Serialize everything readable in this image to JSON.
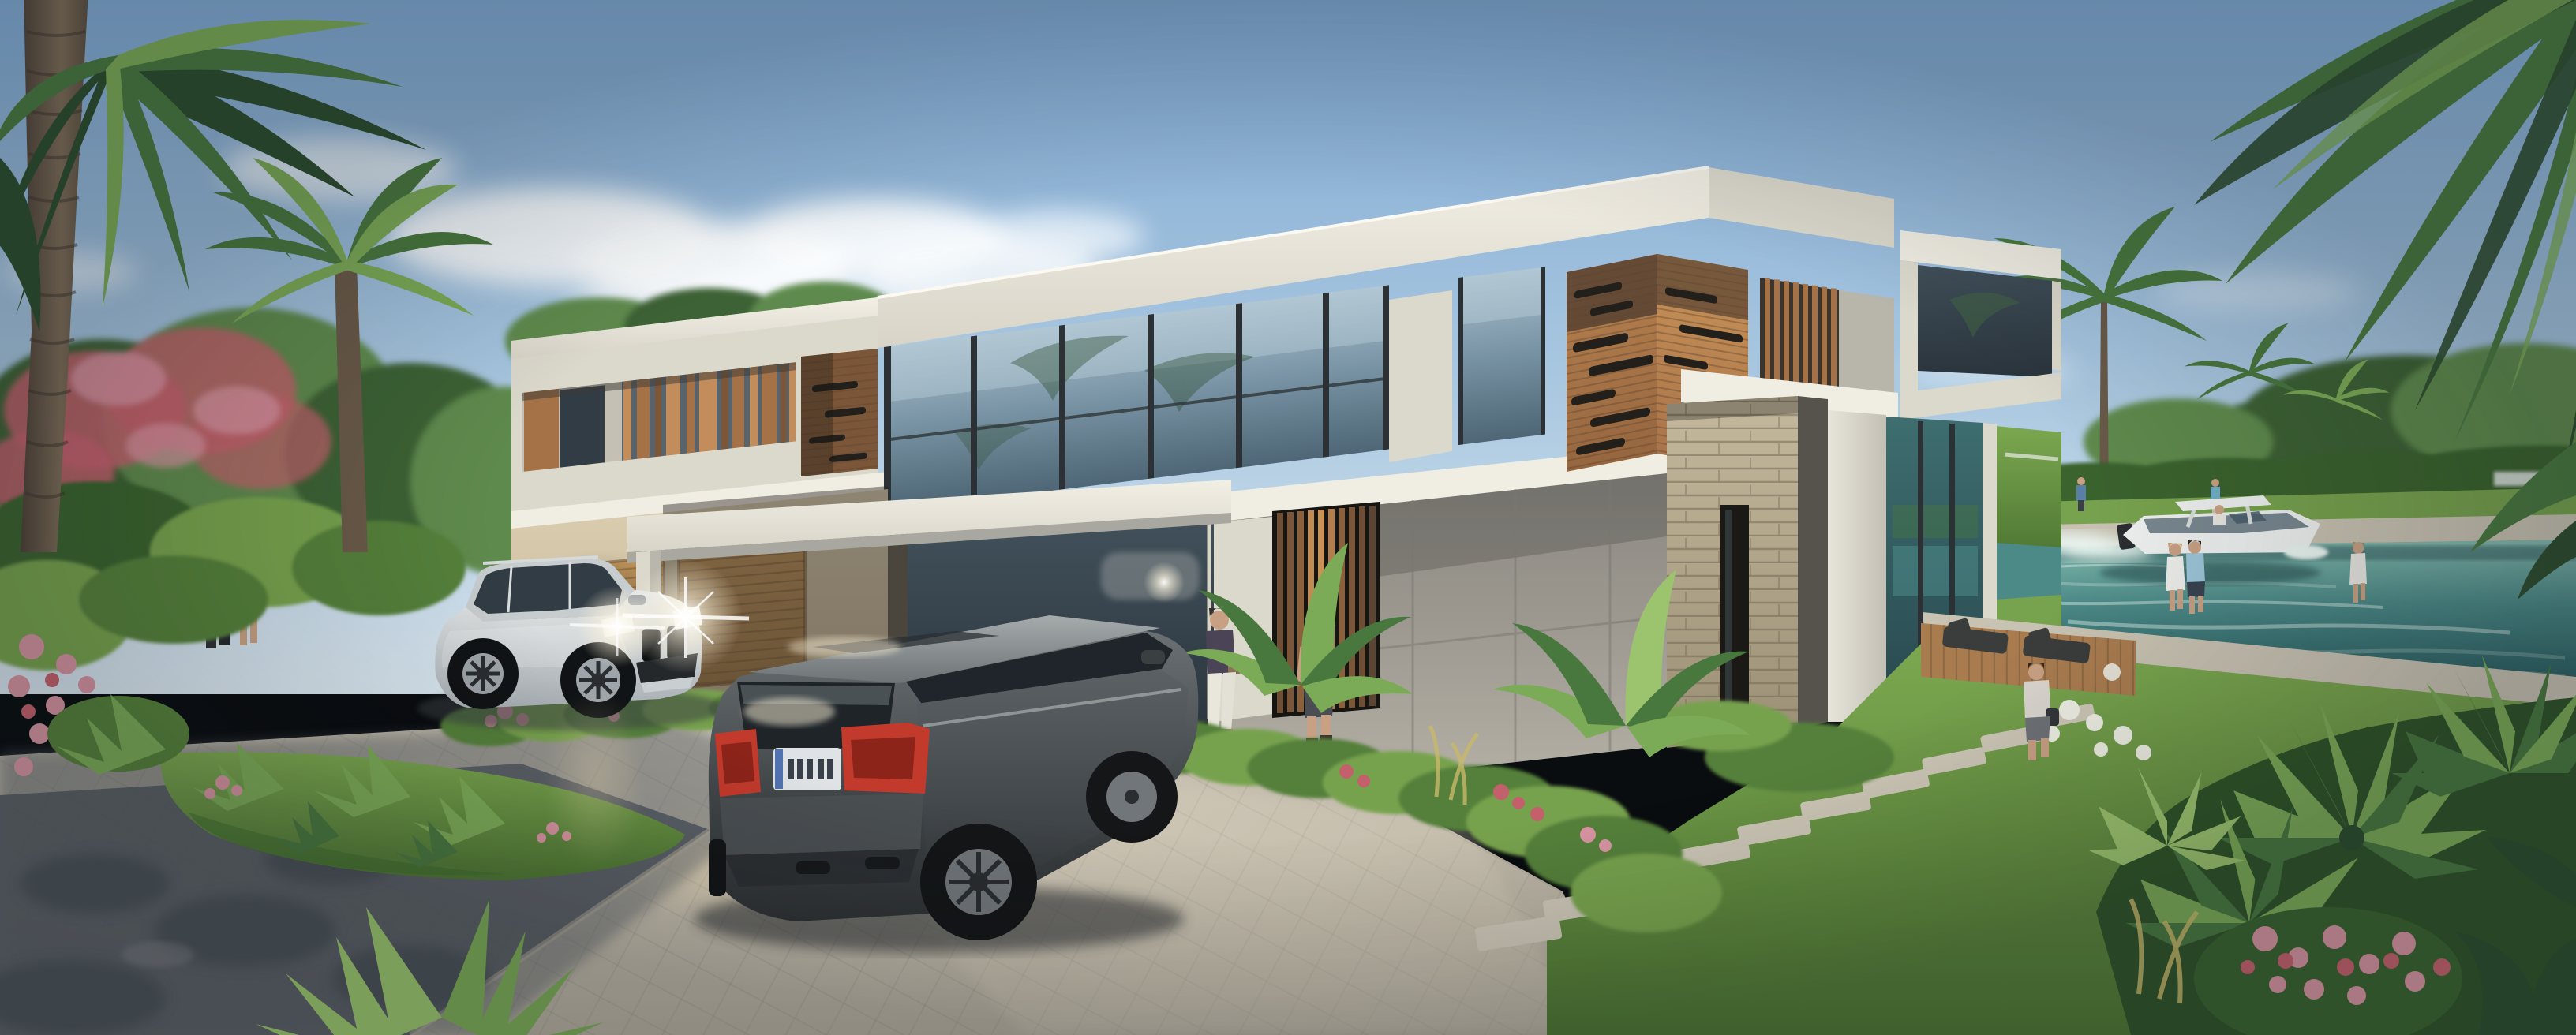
{
  "scene": {
    "title": "Photorealistic 3D architectural rendering of a modern two-story waterfront villa at golden hour",
    "description": "Flat-roof modern villa of white concrete, wood slat cladding and stacked stone with floor-to-ceiling glass; paver driveway with two luxury SUVs, tropical landscaping, coconut palms framing the view, and a canal with a motorboat behind the house.",
    "house": {
      "stories": 2,
      "style": "modern flat-roof volumes",
      "materials": [
        "white concrete fascia",
        "board-form concrete",
        "horizontal wood slat cladding with slot windows",
        "vertical wood louvers",
        "stacked stone pillar",
        "floor-to-ceiling glass"
      ],
      "features": [
        "double garage with wood doors",
        "porte-cochere canopy on slim column",
        "vertical wood-slat entry door",
        "glass corner room overlooking the canal",
        "balcony slab over stone wall"
      ]
    },
    "vehicles": [
      {
        "label": "silver-white luxury SUV",
        "state": "parked facing viewer, headlights on with lens flares"
      },
      {
        "label": "dark gray luxury SUV",
        "state": "parked, seen from rear, red taillights, EU-style license plate (characters illegible)"
      }
    ],
    "water": {
      "label": "teal canal behind the house",
      "boat": "white center-console motorboat with T-top cruising right, leaving a white wake"
    },
    "people": [
      "couple strolling near the garage (left)",
      "couple walking toward the entrance through the garden",
      "man carrying a bag on the stepping-stone path (right)",
      "couple standing on the waterfront promenade",
      "woman walking on the far right path",
      "three tiny figures on the far bank"
    ],
    "vegetation": [
      "coconut palms framing left edge and top-right corner",
      "flowering tree with pink blossoms (left)",
      "tropical beds: agave, fan palms, pink/red/white flowers",
      "trimmed hedge, lawn and trees across the canal"
    ],
    "sky": "clear light blue with soft cumulus clouds",
    "lighting": "low warm sun from the right; long shadows across the paver driveway; dark tree shadow on the asphalt road (bottom left)",
    "ground": [
      "herringbone paver driveway",
      "asphalt road in shade",
      "grass island with spiky plants",
      "stepping-stone path leading to a wood deck with two loungers"
    ]
  },
  "palette": {
    "sky_top": "#7FA9D3",
    "sky_mid": "#A9C7E0",
    "sky_low": "#DAE7F0",
    "cloud": "#FAFCFD",
    "far_tree": "#5F8A4D",
    "far_tree_dark": "#3C6236",
    "hedge": "#3A632F",
    "lawn": "#77A24E",
    "lawn_dark": "#55803A",
    "bloom_pink": "#D794A1",
    "bloom_red": "#C4606C",
    "bloom_white": "#EDEEE3",
    "palm_pale": "#9CC46E",
    "palm_light": "#7CAB57",
    "palm_mid": "#49783F",
    "palm_dark": "#2E4D2F",
    "trunk": "#6A5A49",
    "conc_bright": "#F0EDE3",
    "conc_light": "#DBD8CC",
    "conc_mid": "#B8B5AB",
    "conc_shade": "#94928A",
    "conc_dark": "#6E6C66",
    "soffit": "#A8A7A0",
    "wood_hi": "#C28D5B",
    "wood_mid": "#A57248",
    "wood_low": "#7C5638",
    "wood_deep": "#5C4533",
    "slot": "#231F1B",
    "glass_hi": "#AFC3D1",
    "glass_low": "#4A5D6A",
    "glass_dark": "#323C44",
    "frame": "#2B3134",
    "stone_hi": "#C6BA9F",
    "stone_mid": "#A99D82",
    "water_hi": "#86BBAF",
    "water_mid": "#4C8A88",
    "water_low": "#2C5F62",
    "foam": "#EAF5F1",
    "seawall": "#C8C2B2",
    "pave_sun": "#CCC5B4",
    "pave_mid": "#B1AA9B",
    "road": "#575D64",
    "skin": "#C8A184",
    "deck": "#A97C50",
    "tail": "#C23A2C",
    "plate": "#DFE3E5",
    "warm_glow": "#FFE9B8"
  }
}
